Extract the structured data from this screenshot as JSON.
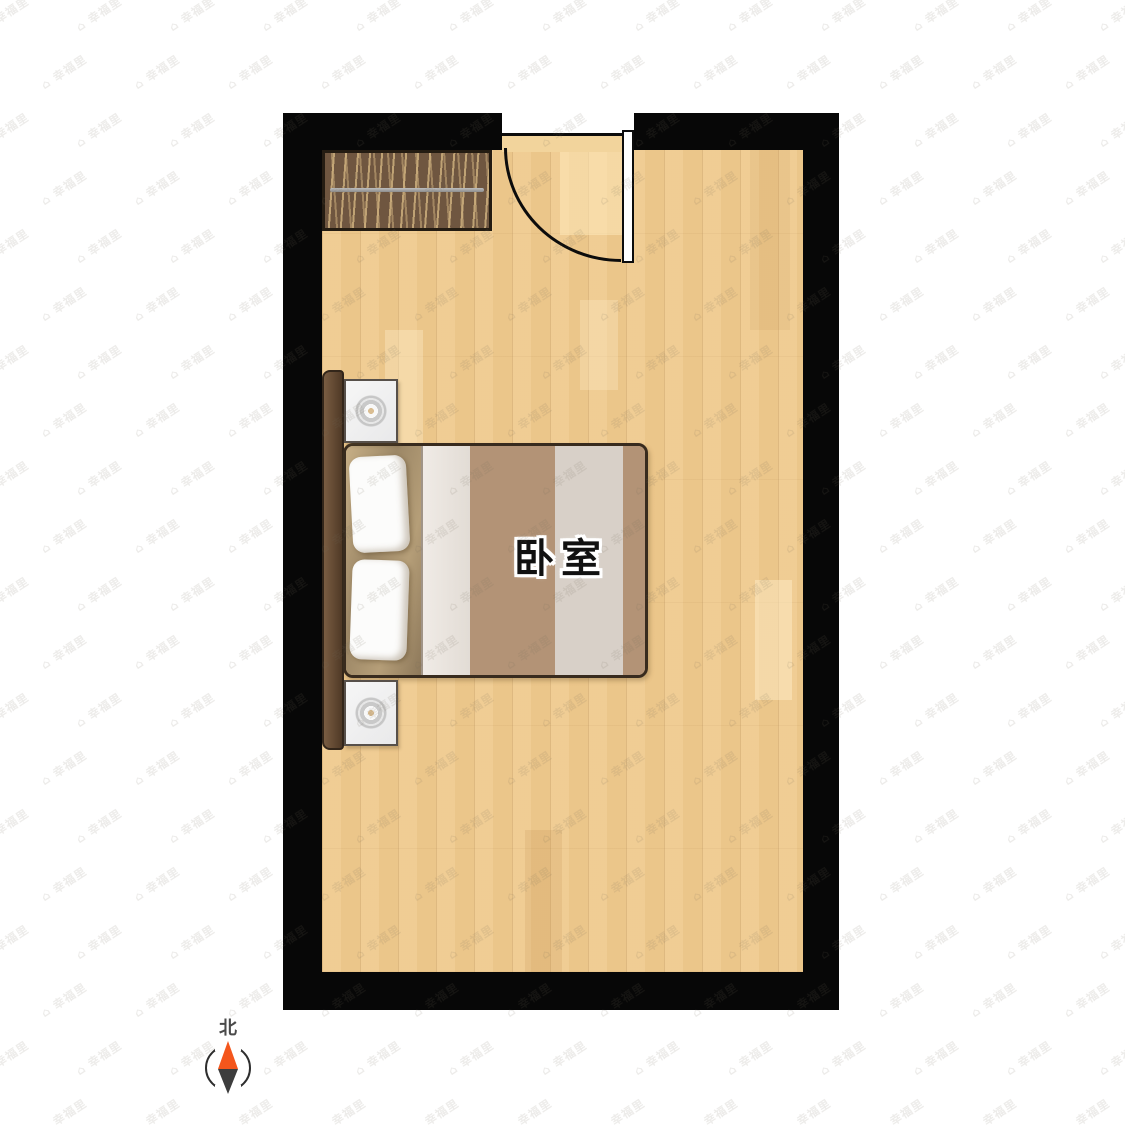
{
  "floorplan": {
    "room_label": "卧室",
    "wall_color": "#070707",
    "floor_color": "#efca8e",
    "furniture": {
      "wardrobe": "wardrobe-with-hanging-rail",
      "bed": "double-bed",
      "nightstands": 2,
      "door": "single-swing-door"
    }
  },
  "compass": {
    "north_label": "北",
    "north_color": "#f4561c",
    "south_color": "#3d3d3d"
  },
  "watermark": {
    "icon": "⌂",
    "text": "幸福里",
    "color": "rgba(118,108,96,0.13)",
    "rows": 20,
    "cols": 14,
    "dx": 93,
    "dy": 58,
    "stagger": 35,
    "rotate_deg": -33
  },
  "icons": {
    "compass_needle": "compass-needle-icon",
    "table_lamp": "table-lamp-icon",
    "watermark_house": "house-icon"
  }
}
